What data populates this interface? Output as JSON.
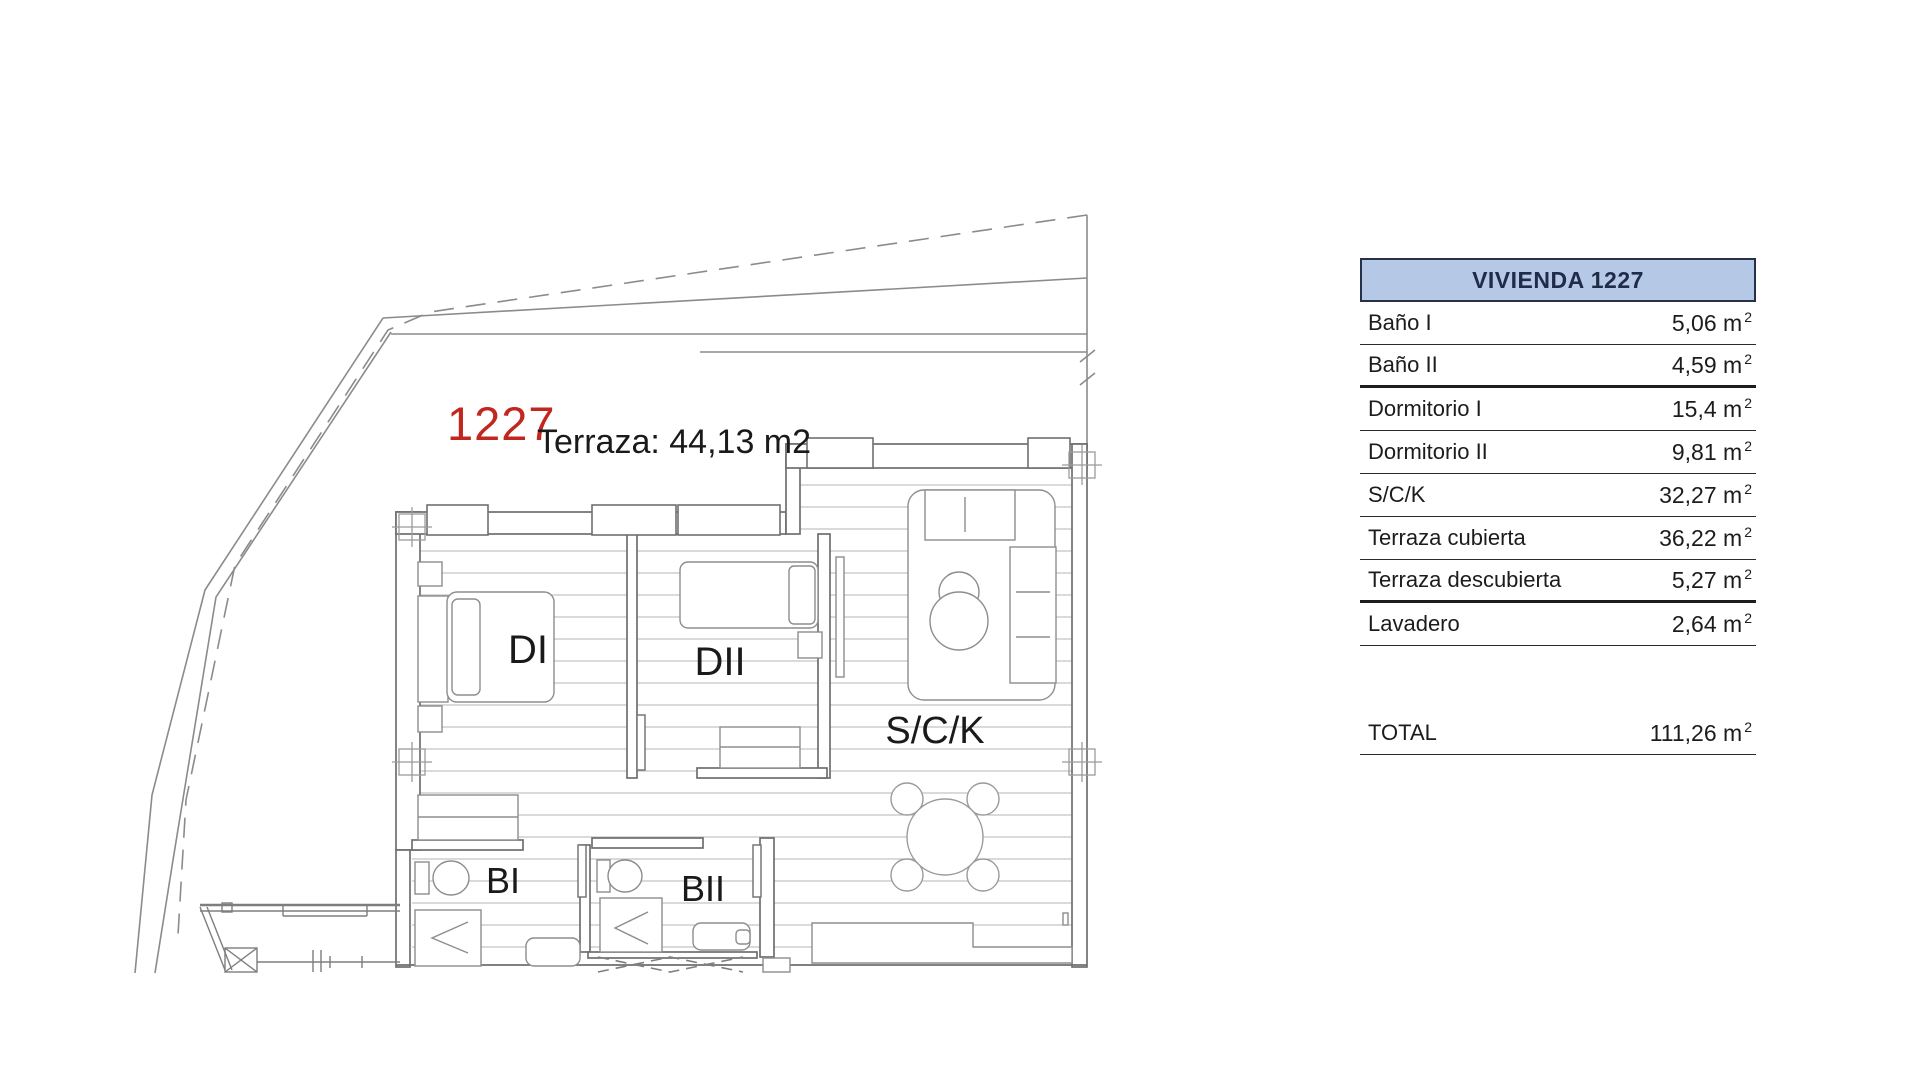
{
  "plan": {
    "unit_number": "1227",
    "terrace_note": "Terraza: 44,13 m2",
    "accent_red": "#c1271f",
    "rooms": {
      "dormitorio1": "DI",
      "dormitorio2": "DII",
      "salon_cocina": "S/C/K",
      "bano1": "BI",
      "bano2": "BII"
    }
  },
  "table": {
    "title": "VIVIENDA 1227",
    "unit_base": "m",
    "unit_exp": "2",
    "rows": [
      {
        "label": "Baño I",
        "value": "5,06"
      },
      {
        "label": "Baño II",
        "value": "4,59"
      },
      {
        "label": "Dormitorio I",
        "value": "15,4"
      },
      {
        "label": "Dormitorio II",
        "value": "9,81"
      },
      {
        "label": "S/C/K",
        "value": "32,27"
      },
      {
        "label": "Terraza cubierta",
        "value": "36,22"
      },
      {
        "label": "Terraza descubierta",
        "value": "5,27"
      },
      {
        "label": "Lavadero",
        "value": "2,64"
      }
    ],
    "total": {
      "label": "TOTAL",
      "value": "111,26"
    },
    "colors": {
      "header_bg": "#b5c8e6",
      "header_border": "#26324a",
      "header_text": "#1e2c48",
      "row_line": "#2b2b2b"
    }
  }
}
